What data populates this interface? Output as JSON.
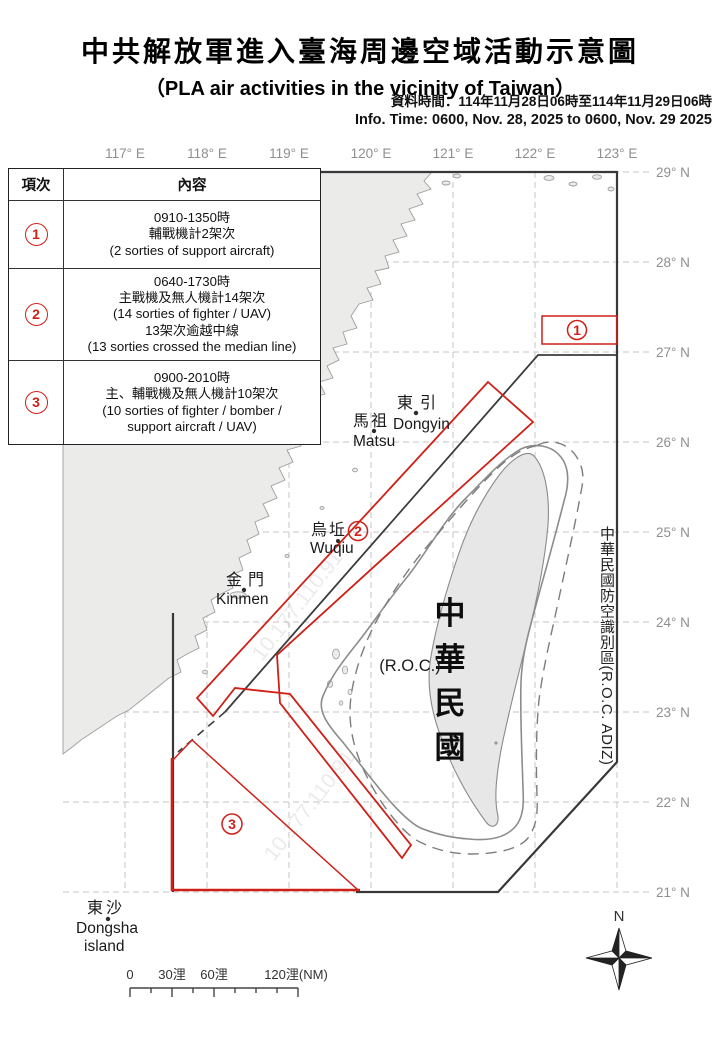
{
  "header": {
    "title_zh": "中共解放軍進入臺海周邊空域活動示意圖",
    "title_en": "（PLA air activities in the vicinity of Taiwan）",
    "info_zh": "資料時間：114年11月28日06時至114年11月29日06時",
    "info_en": "Info. Time: 0600, Nov. 28, 2025 to 0600, Nov. 29 2025"
  },
  "table": {
    "header_item": "項次",
    "header_content": "內容",
    "rows": [
      {
        "num": "1",
        "lines": [
          "0910-1350時",
          "輔戰機計2架次",
          "(2 sorties of support aircraft)"
        ]
      },
      {
        "num": "2",
        "lines": [
          "0640-1730時",
          "主戰機及無人機計14架次",
          "(14 sorties of fighter / UAV)",
          "13架次逾越中線",
          "(13 sorties crossed the median line)"
        ]
      },
      {
        "num": "3",
        "lines": [
          "0900-2010時",
          "主、輔戰機及無人機計10架次",
          "(10 sorties of fighter / bomber /",
          "support aircraft / UAV)"
        ]
      }
    ]
  },
  "map": {
    "lon_labels": [
      "117° E",
      "118° E",
      "119° E",
      "120° E",
      "121° E",
      "122° E",
      "123° E"
    ],
    "lat_labels": [
      "29° N",
      "28° N",
      "27° N",
      "26° N",
      "25° N",
      "24° N",
      "23° N",
      "22° N",
      "21° N"
    ],
    "places": {
      "dongyin": {
        "zh": "東引",
        "en": "Dongyin"
      },
      "matsu": {
        "zh": "馬祖",
        "en": "Matsu"
      },
      "wuqiu": {
        "zh": "烏坵",
        "en": "Wuqiu"
      },
      "kinmen": {
        "zh": "金門",
        "en": "Kinmen"
      },
      "dongsha": {
        "zh": "東沙",
        "en": "Dongsha",
        "en2": "island"
      }
    },
    "taiwan": {
      "name_vertical": [
        "中",
        "華",
        "民",
        "國"
      ],
      "roc": "(R.O.C.)"
    },
    "adiz_label": "中華民國防空識別區(R.O.C. ADIZ)",
    "zone_markers": {
      "z1": "1",
      "z2": "2",
      "z3": "3"
    },
    "scalebar": {
      "t0": "0",
      "t30": "30浬",
      "t60": "60浬",
      "t120": "120浬(NM)"
    },
    "compass": "N",
    "watermark": "10.177.110.91",
    "colors": {
      "zone_red": "#cf2018",
      "boundary": "#383838",
      "grid": "#c6c6c6"
    }
  }
}
